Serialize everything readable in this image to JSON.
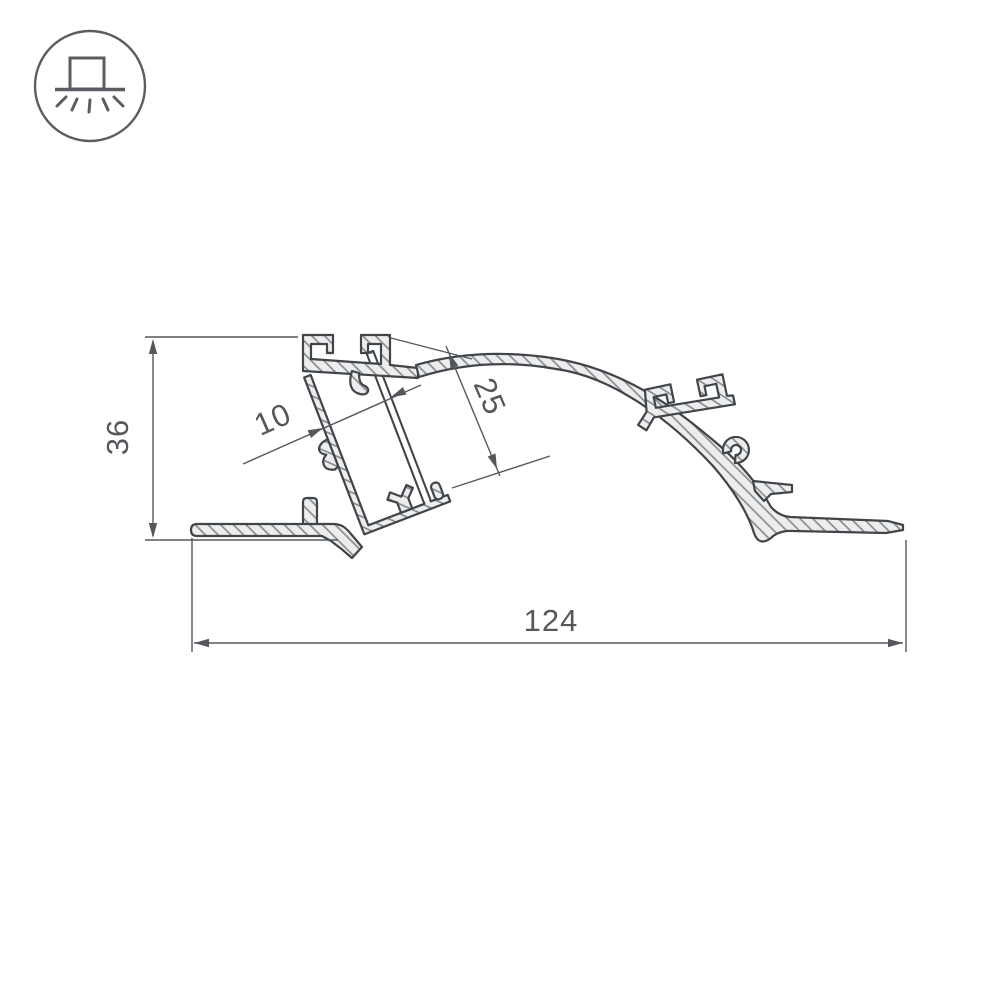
{
  "page": {
    "background": "#ffffff"
  },
  "icon": {
    "name": "surface-mounted-light-icon",
    "meaning": "profile with downward light emission"
  },
  "drawing": {
    "subject": "LED aluminium profile cross-section",
    "colors": {
      "outline": "#40454a",
      "dimension": "#54585c",
      "material_fill": "#ededee",
      "hatch": "#82878b",
      "icon": "#5a5e62"
    }
  },
  "dimensions": {
    "overall_height": "36",
    "overall_width": "124",
    "slot_width": "10",
    "slot_depth": "25"
  }
}
